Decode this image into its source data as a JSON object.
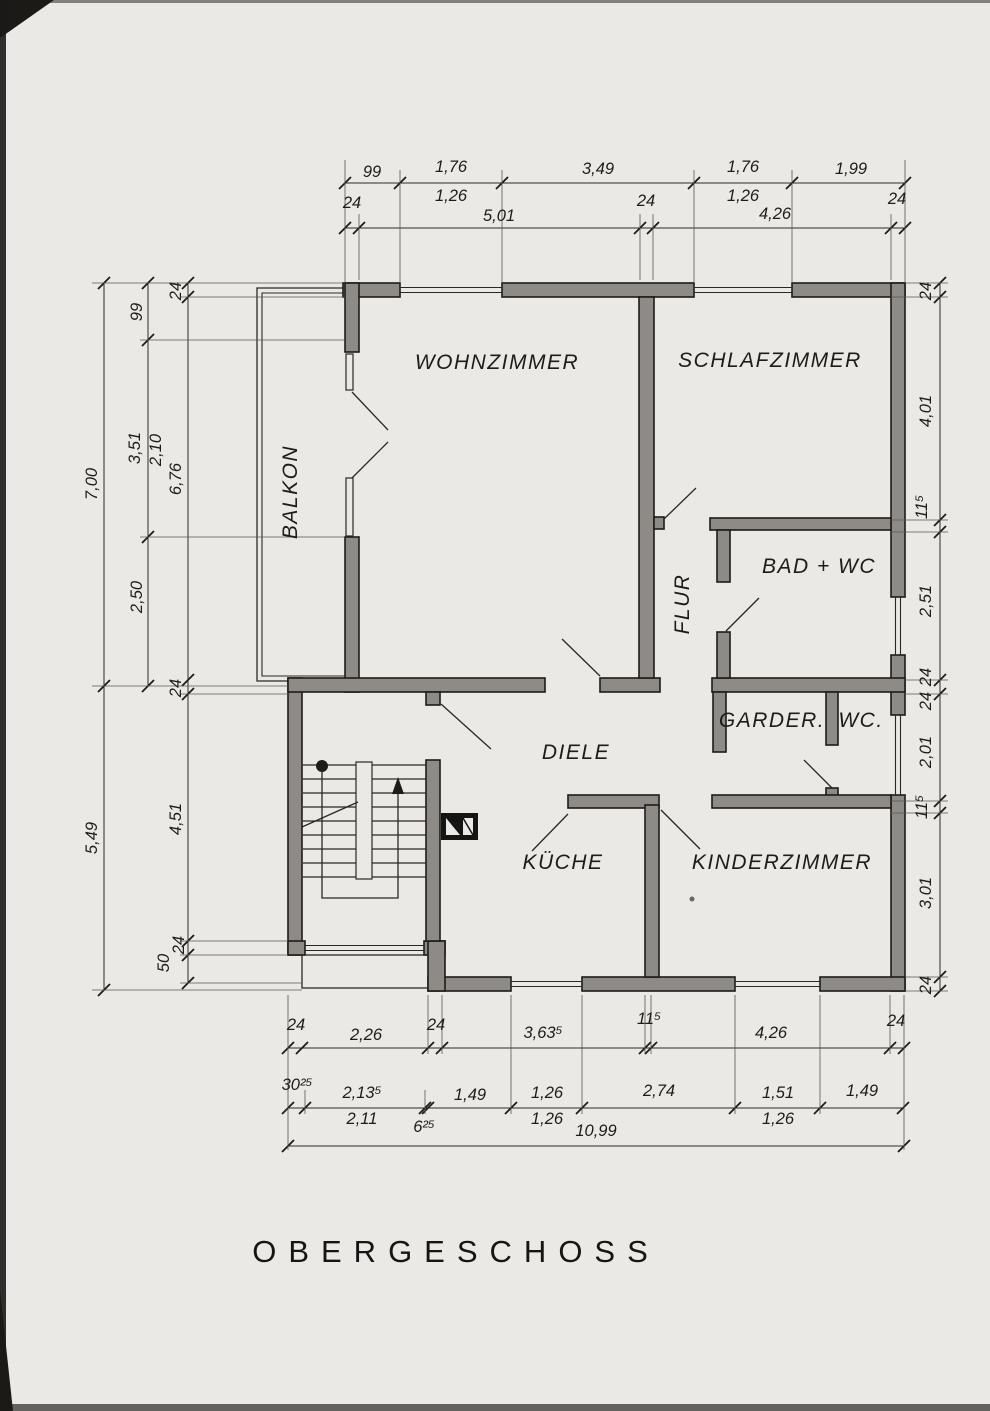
{
  "title": "OBERGESCHOSS",
  "rooms": {
    "wohnzimmer": "WOHNZIMMER",
    "schlafzimmer": "SCHLAFZIMMER",
    "balkon": "BALKON",
    "flur": "FLUR",
    "bad": "BAD + WC",
    "garderobe": "GARDER.",
    "wc": "WC.",
    "diele": "DIELE",
    "kueche": "KÜCHE",
    "kinderzimmer": "KINDERZIMMER"
  },
  "dims": {
    "top1": [
      "99",
      "1,76",
      "3,49",
      "1,76",
      "1,99"
    ],
    "top1_sub": [
      "1,26",
      "1,26"
    ],
    "top2": [
      "24",
      "5,01",
      "24",
      "4,26",
      "24"
    ],
    "left_outer": [
      "7,00",
      "5,49"
    ],
    "left_mid": [
      "99",
      "3,51",
      "2,50"
    ],
    "left_mid_sub": [
      "2,10"
    ],
    "left_inner": [
      "24",
      "6,76",
      "24",
      "4,51",
      "24",
      "50"
    ],
    "right": [
      "24",
      "4,01",
      "11⁵",
      "2,51",
      "24",
      "24",
      "2,01",
      "11⁵",
      "3,01",
      "24"
    ],
    "bottom1": [
      "24",
      "2,26",
      "24",
      "3,63⁵",
      "11⁵",
      "4,26",
      "24"
    ],
    "bottom2": [
      "30²⁵",
      "2,13⁵",
      "2,11",
      "6²⁵",
      "1,49",
      "1,26",
      "1,26",
      "2,74",
      "1,51",
      "1,26",
      "1,49"
    ],
    "total": "10,99"
  },
  "colors": {
    "paper": "#eae9e5",
    "wall_fill": "#8e8b86",
    "ink": "#1d1c1a"
  }
}
